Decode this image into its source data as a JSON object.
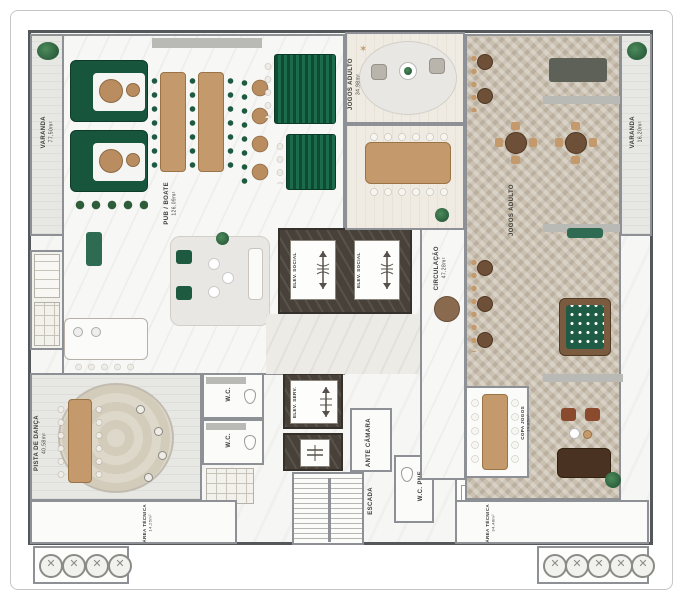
{
  "plan": {
    "rooms": {
      "varanda_left": {
        "name": "VARANDA",
        "area": "77,50m²"
      },
      "varanda_right": {
        "name": "VARANDA",
        "area": "16,20m²"
      },
      "pub": {
        "name": "PUB / BOATE",
        "area": "126,09m²"
      },
      "jogos_lounge": {
        "name": "JOGOS ADULTO",
        "area": "34,98m²"
      },
      "salao_jogos": {
        "name": "JOGOS ADULTO",
        "area": ""
      },
      "circulacao": {
        "name": "CIRCULAÇÃO",
        "area": "47,28m²"
      },
      "pista_danca": {
        "name": "PISTA DE DANÇA",
        "area": "40,58m²"
      },
      "area_tecnica_esq": {
        "name": "ÁREA TÉCNICA",
        "area": "14,25m²"
      },
      "area_tecnica_dir": {
        "name": "ÁREA TÉCNICA",
        "area": "34,48m²"
      },
      "copa_jogos": {
        "name": "COPA JOGOS",
        "area": "19,85m²"
      },
      "elev_social": {
        "name": "ELEV. SOCIAL"
      },
      "elev_serv": {
        "name": "ELEV. SERV."
      },
      "ante_camara": {
        "name": "ANTE CÂMARA"
      },
      "escada": {
        "name": "ESCADA"
      },
      "wc": {
        "name": "W.C."
      },
      "wc_pne": {
        "name": "W.C. PNE"
      }
    },
    "colors": {
      "accent_green": "#17563c",
      "teal": "#2e6b52",
      "wood": "#c49a6c",
      "herringbone": "#cbc1b0",
      "dark_marble": "#474139",
      "rust": "#8a4a2e"
    }
  }
}
